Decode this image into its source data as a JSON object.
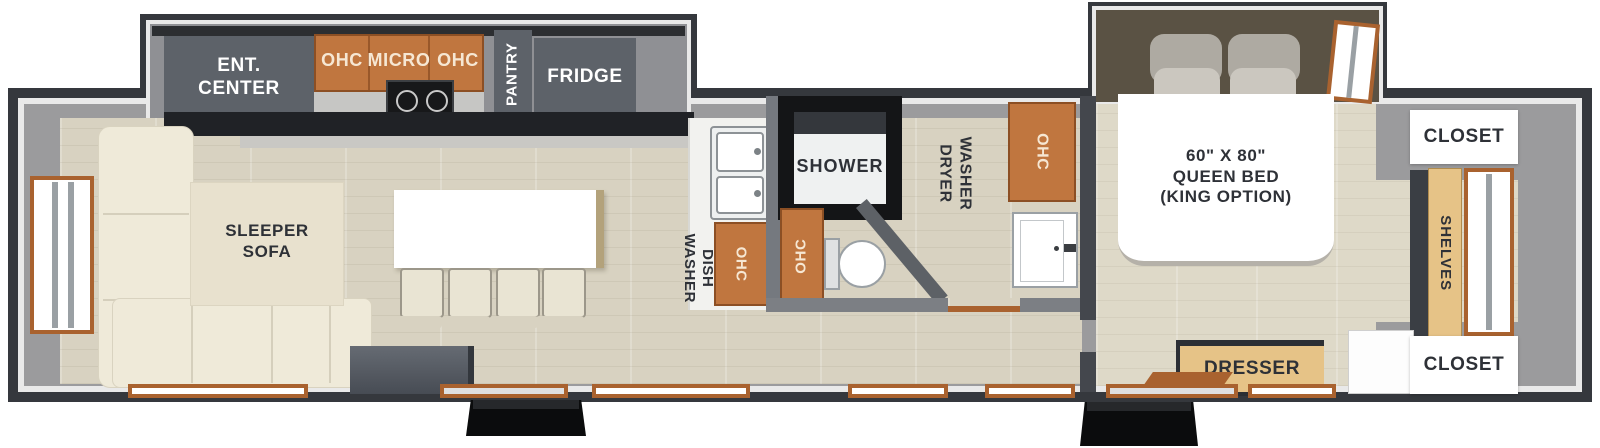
{
  "floorplan": {
    "type": "travel-trailer-floorplan",
    "labels": {
      "ent_center": "ENT.\nCENTER",
      "ohc_left": "OHC",
      "micro": "MICRO",
      "ohc_right": "OHC",
      "pantry": "PANTRY",
      "fridge": "FRIDGE",
      "sleeper_sofa": "SLEEPER\nSOFA",
      "dish_washer": "DISH\nWASHER",
      "ohc_kitchen": "OHC",
      "shower": "SHOWER",
      "ohc_bath": "OHC",
      "washer_dryer": "WASHER\nDRYER",
      "ohc_washer": "OHC",
      "queen_bed": "60\" X 80\"\nQUEEN BED\n(KING OPTION)",
      "closet_top": "CLOSET",
      "shelves": "SHELVES",
      "closet_bottom": "CLOSET",
      "dresser": "DRESSER"
    },
    "colors": {
      "hull_dark": "#35383d",
      "wall_gray": "#9b9b9d",
      "floor_beige": "#d8d2c1",
      "cabinet_gray": "#5d6269",
      "cabinet_orange": "#c0763f",
      "wood_tan": "#e6c387",
      "sofa_cream": "#efead9",
      "window_frame_orange": "#a9622f",
      "label_dark": "#2e3137",
      "label_cream": "#f6e7d3"
    }
  }
}
